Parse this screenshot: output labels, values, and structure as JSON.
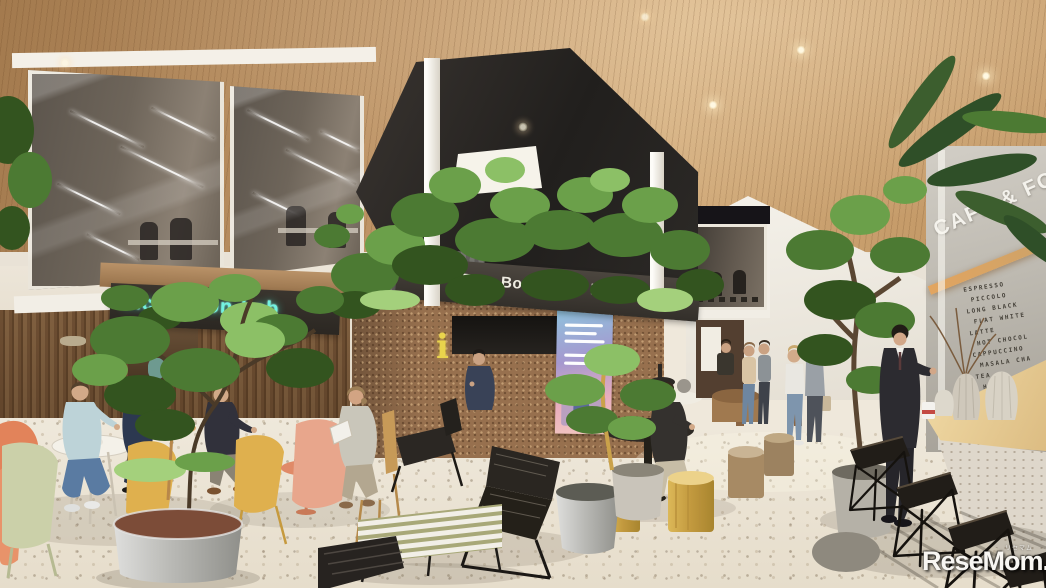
{
  "scene": {
    "type": "architectural-rendering",
    "description": "CG perspective rendering of a two-story incubation-facility atrium: wood-slat ceiling with downlights, dark planted canopy over a cork-clad reception hub, glass mezzanine offices, neon lab sign, cafe counter with bar stools, lounge seating with people and potted trees on a white terrazzo floor"
  },
  "signs": {
    "banner": "Be a Borderless Innovator.",
    "neon": "Incubation-Lab",
    "info": "i"
  },
  "cafe": {
    "title": "CAFE & FOOD",
    "menu": [
      "ESPRESSO",
      "PICCOLO",
      "LONG BLACK",
      "FLAT WHITE",
      "LATTE",
      "HOT CHOCOL",
      "CAPPUCCINO",
      "MASALA CHA",
      "TEA",
      "HAVE A NICE"
    ]
  },
  "watermark": {
    "text": "ReseMom.",
    "furigana": "リセマム"
  },
  "palette": {
    "ceiling_wood": "#c09060",
    "canopy_dark": "#2a2724",
    "banner_band": "#45403a",
    "banner_text": "#efece2",
    "neon_cyan": "#72f2e0",
    "cork_wall": "#97704e",
    "terrazzo_floor": "#eae3d7",
    "counter_wood": "#e9cf9d",
    "foliage_green": "#5d8a43",
    "chair_orange": "#e2835a",
    "chair_yellow": "#dfb04e",
    "chair_sage": "#cbd0a9",
    "chair_salmon": "#e8a68c",
    "signage_gradient_top": "#8fc3dd",
    "signage_gradient_bottom": "#f2c8c0"
  }
}
